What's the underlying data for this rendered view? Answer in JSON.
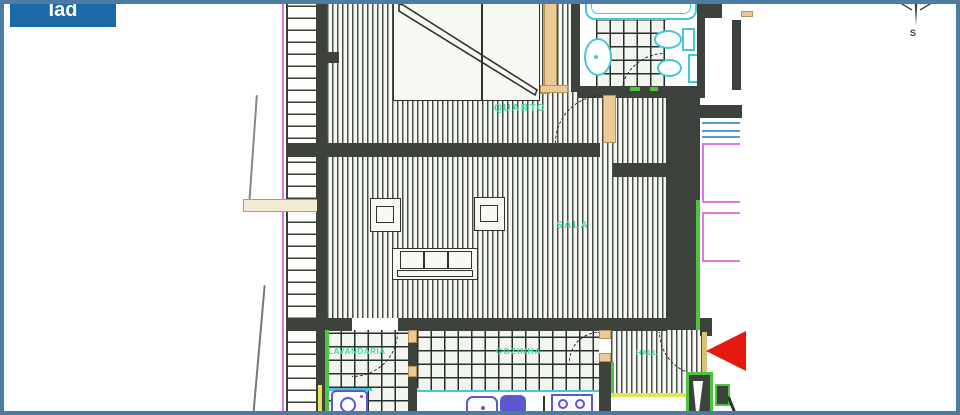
{
  "window": {
    "frame_color": "#4d7ba2",
    "background": "#ffffff"
  },
  "branding": {
    "logo_text": "Iad",
    "logo_bg_color": "#1b6aa5",
    "logo_text_color": "#ffffff"
  },
  "compass": {
    "south_label": "S"
  },
  "floor_plan": {
    "room_labels": {
      "quarto": "QUARTO",
      "sala": "SALA",
      "lavandaria": "LAVANDARIA",
      "cozinha": "COZINHA",
      "hall": "HALL"
    },
    "label_color": "#3bdfa3",
    "palette": {
      "wall_dark": "#3d423c",
      "floor_stripe": "#49514b",
      "tile_line": "#26312b",
      "fixture_cyan": "#49c5d8",
      "appliance_blue": "#5a59cf",
      "door_tan": "#ecca97",
      "railing_magenta": "#e275e5",
      "window_blue": "#4f9fd6",
      "accent_green": "#4cc43c",
      "accent_yellow": "#e3e356",
      "marker_red": "#e6190e"
    },
    "fixture_names": [
      "bathtub",
      "washbasin",
      "toilet",
      "bidet",
      "shower-screen",
      "wardrobe",
      "armchair",
      "armchair",
      "sofa",
      "washing-machine",
      "kitchen-sink",
      "stove"
    ],
    "marker": {
      "type": "entrance-arrow",
      "direction": "left",
      "color": "#e6190e"
    }
  }
}
